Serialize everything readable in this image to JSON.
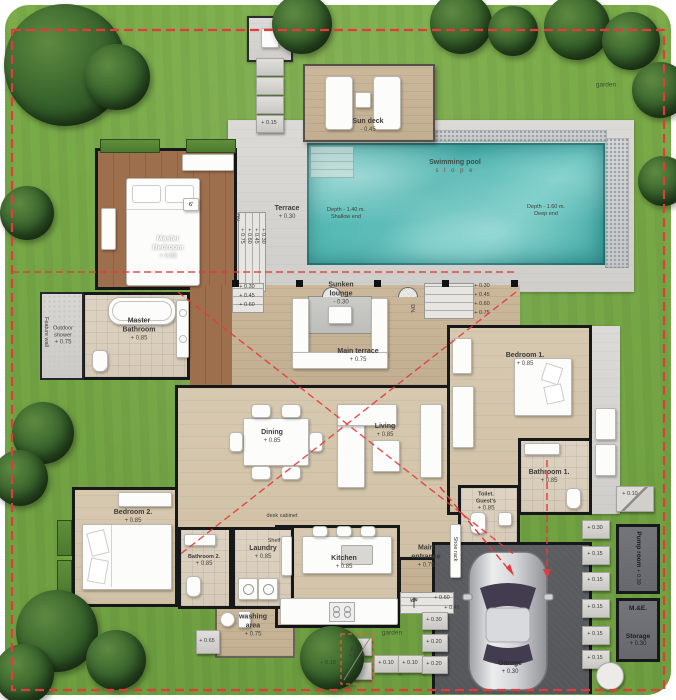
{
  "colors": {
    "boundary_red": "#e23b3b",
    "entry_dash_orange": "#e0603a",
    "pool_teal": "#52bcb7",
    "lawn_green": "#76ab47",
    "deck_gray": "#d7d6d2",
    "wood_brown": "#9b6c49",
    "floor_beige": "#d2c4aa",
    "terrace_tan": "#c6b295",
    "garage_gray": "#56585c"
  },
  "rooms": {
    "sun_deck": {
      "label": "Sun deck",
      "level": "- 0.45"
    },
    "pool": {
      "label": "Swimming pool",
      "slope": "s l o p e",
      "shallow1": "Depth - 1.40 m.",
      "shallow2": "Shallow end",
      "deep1": "Depth - 1.60 m.",
      "deep2": "Deep end"
    },
    "terrace": {
      "label": "Terrace",
      "level": "+ 0.30"
    },
    "master_bedroom": {
      "label": "Master",
      "label2": "Bedroom",
      "level": "+ 0.85",
      "bed_tag": "6'"
    },
    "master_bathroom": {
      "label": "Master",
      "label2": "Bathroom",
      "level": "+ 0.85"
    },
    "outdoor_shower": {
      "label": "Outdoor",
      "label2": "shower",
      "level": "+ 0.75"
    },
    "feature_wall": {
      "label": "Feature wall"
    },
    "sunken_lounge": {
      "label": "Sunken",
      "label2": "lounge",
      "level": "- 0.30"
    },
    "main_terrace": {
      "label": "Main terrace",
      "level": "+ 0.75"
    },
    "dining": {
      "label": "Dining",
      "level": "+ 0.85"
    },
    "living": {
      "label": "Living",
      "level": "+ 0.85"
    },
    "kitchen": {
      "label": "Kitchen",
      "level": "+ 0.85"
    },
    "bedroom1": {
      "label": "Bedroom 1.",
      "level": "+ 0.85"
    },
    "bathroom1": {
      "label": "Bathroom 1.",
      "level": "+ 0.85"
    },
    "toilet_guests": {
      "label": "Toilet.",
      "label2": "Guest's",
      "level": "+ 0.85"
    },
    "bedroom2": {
      "label": "Bedroom 2.",
      "level": "+ 0.85"
    },
    "bathroom2": {
      "label": "Bathroom 2.",
      "level": "+ 0.85"
    },
    "laundry": {
      "label": "Laundry",
      "level": "+ 0.85"
    },
    "washing_area": {
      "label": "washing",
      "label2": "area",
      "level": "+ 0.75"
    },
    "main_entrance": {
      "label": "Main",
      "label2": "entrance",
      "level": "+ 0.75"
    },
    "garage": {
      "label": "Garage",
      "level": "+ 0.30"
    },
    "pump_room": {
      "label": "Pump room",
      "level": "+ 0.30"
    },
    "me": {
      "label": "M.&E."
    },
    "storage": {
      "label": "Storage",
      "level": "+ 0.30"
    }
  },
  "annotations": {
    "garden_bottom": "garden",
    "garden_top": "garden",
    "entry": {
      "label": "Entry",
      "level": "+ 0.10"
    },
    "shoe_rack": "Shoe rack",
    "desk_cabinet": "desk cabinet",
    "shelf": "Shelf",
    "dn": "DN.",
    "dn2": "DN.",
    "up": "UP"
  },
  "levels": {
    "master_steps": [
      "+ 0.75",
      "+ 0.60",
      "+ 0.45",
      "+ 0.30"
    ],
    "terrace_steps_left": [
      "+ 0.30",
      "+ 0.45",
      "+ 0.60"
    ],
    "terrace_steps_right": [
      "+ 0.30",
      "+ 0.45",
      "+ 0.60",
      "+ 0.75"
    ],
    "entrance_steps": [
      "+ 0.60",
      "+ 0.45"
    ],
    "path_stone_top": "+ 0.15",
    "stone_right_top": "+ 0.10",
    "right_column": [
      "+ 0.30",
      "+ 0.15",
      "+ 0.15",
      "+ 0.15",
      "+ 0.15",
      "+ 0.15"
    ],
    "bottom_row": [
      "+ 0.10",
      "+ 0.10",
      "+ 0.10"
    ],
    "entrance_column": [
      "+ 0.30",
      "+ 0.20",
      "+ 0.20"
    ],
    "washing_stone": "+ 0.65"
  }
}
